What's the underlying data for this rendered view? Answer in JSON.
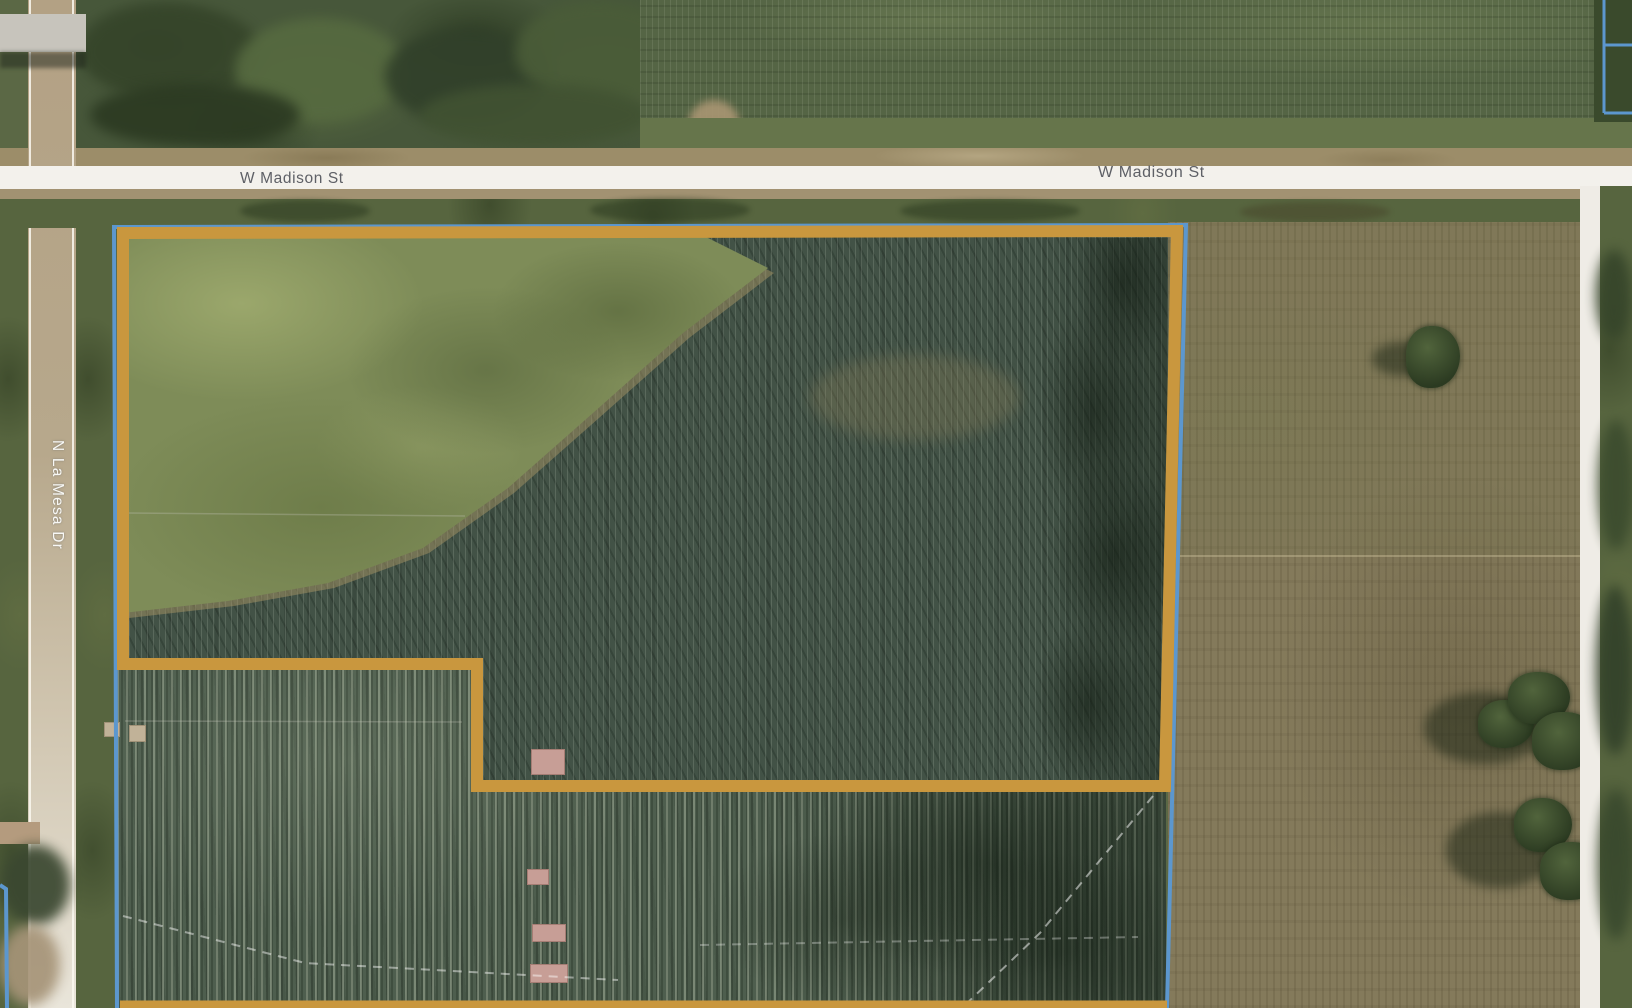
{
  "map": {
    "view": "aerial-satellite-parcel-view",
    "street_labels": [
      {
        "text": "W Madison St",
        "orientation": "horizontal"
      },
      {
        "text": "W Madison St",
        "orientation": "horizontal"
      },
      {
        "text": "N La Mesa Dr",
        "orientation": "vertical"
      }
    ],
    "overlay_colors": {
      "highlight_gold": "#C9973E",
      "parcel_blue": "#5C97CE",
      "dashed_white": "#FFFFFF"
    }
  }
}
